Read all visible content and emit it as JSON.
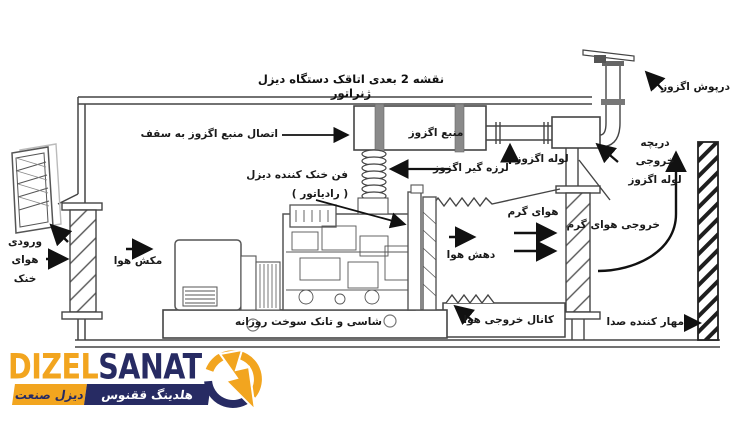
{
  "title": "نقشه 2 بعدی اتاقک دستگاه دیزل ژنراتور",
  "diagram_labels": {
    "exhaust_source": "منبع اگزوز",
    "exhaust_source_ceiling_connection": "اتصال منبع اگزوز به سقف",
    "exhaust_vibration_isolator": "لرزه گیر اگزوز",
    "diesel_cooling_fan": "فن خنک کننده دیزل",
    "diesel_cooling_fan_sub": "( رادیاتور )",
    "exhaust_pipe": "لوله اگزوز",
    "exhaust_cap": "درپوش اگزوز",
    "exhaust_pipe_outlet_hatch": "دریچه\nخروجی\nلوله اگزوز",
    "warm_air": "هوای گرم",
    "warm_air_outlet": "خروجی هوای گرم",
    "air_discharge": "دهش هوا",
    "air_suction": "مکش هوا",
    "cool_air_inlet": "ورودی\nهوای\nخنک",
    "chassis_daily_fuel_tank": "شاسی و تانک سوخت روزانه",
    "air_outlet_duct": "کانال خروجی هوا",
    "sound_suppressor": "مهار کننده صدا"
  },
  "logo": {
    "wordmark_first": "DIZEL",
    "wordmark_second": "SANAT",
    "banner_navy": "هلدینگ ققنوس",
    "banner_orange": "دیزل صنعت",
    "colors": {
      "orange": "#F2A51F",
      "navy": "#272B63",
      "line": "#444444"
    }
  }
}
